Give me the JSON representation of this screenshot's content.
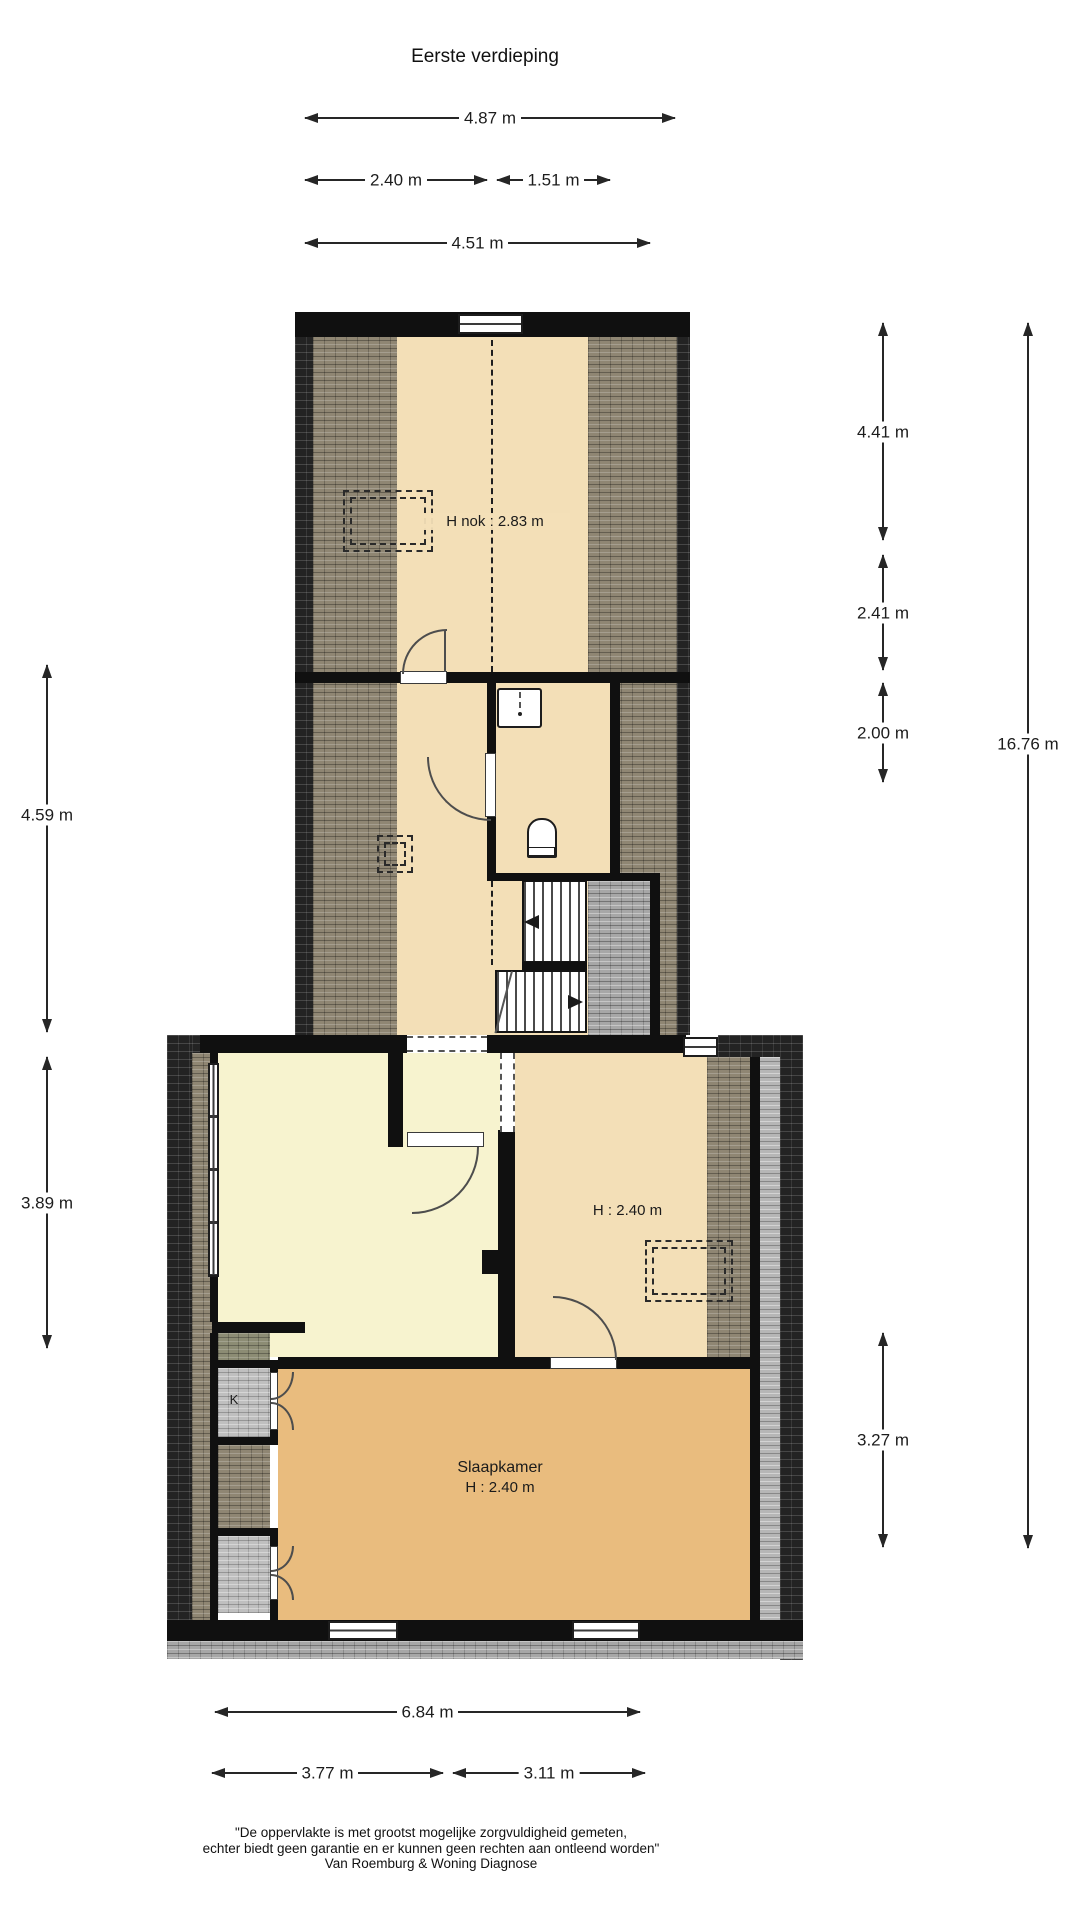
{
  "title": "Eerste verdieping",
  "dims": {
    "top_full": "4.87 m",
    "top_left": "2.40 m",
    "top_right": "1.51 m",
    "top_inner": "4.51 m",
    "left_upper": "4.59 m",
    "left_lower": "3.89 m",
    "right_attic": "4.41 m",
    "right_mid": "2.41 m",
    "right_stairs": "2.00 m",
    "right_bedroom": "3.27 m",
    "right_total": "16.76 m",
    "bottom_full": "6.84 m",
    "bottom_left": "3.77 m",
    "bottom_right": "3.11 m"
  },
  "rooms": {
    "attic": "H nok : 2.83 m",
    "landing": "H : 2.40 m",
    "bedroom_name": "Slaapkamer",
    "bedroom_h": "H : 2.40 m",
    "closet": "K"
  },
  "footer": {
    "line1": "\"De oppervlakte is met grootst mogelijke zorgvuldigheid gemeten,",
    "line2": "echter biedt geen garantie en er kunnen geen rechten aan ontleend worden\"",
    "line3": "Van Roemburg & Woning Diagnose"
  },
  "colors": {
    "wall": "#101010",
    "floor_cream": "#f3dfb7",
    "floor_pale_yellow": "#f7f3cf",
    "floor_bedroom_orange": "#e9bc7e",
    "roof_tiles_brown": "#8f8673",
    "roof_tiles_dark": "#232323",
    "roof_tiles_grey": "#a7a7a7",
    "closet_grey": "#bfbfbf",
    "roof_tiles_olive": "#8c8c74"
  }
}
